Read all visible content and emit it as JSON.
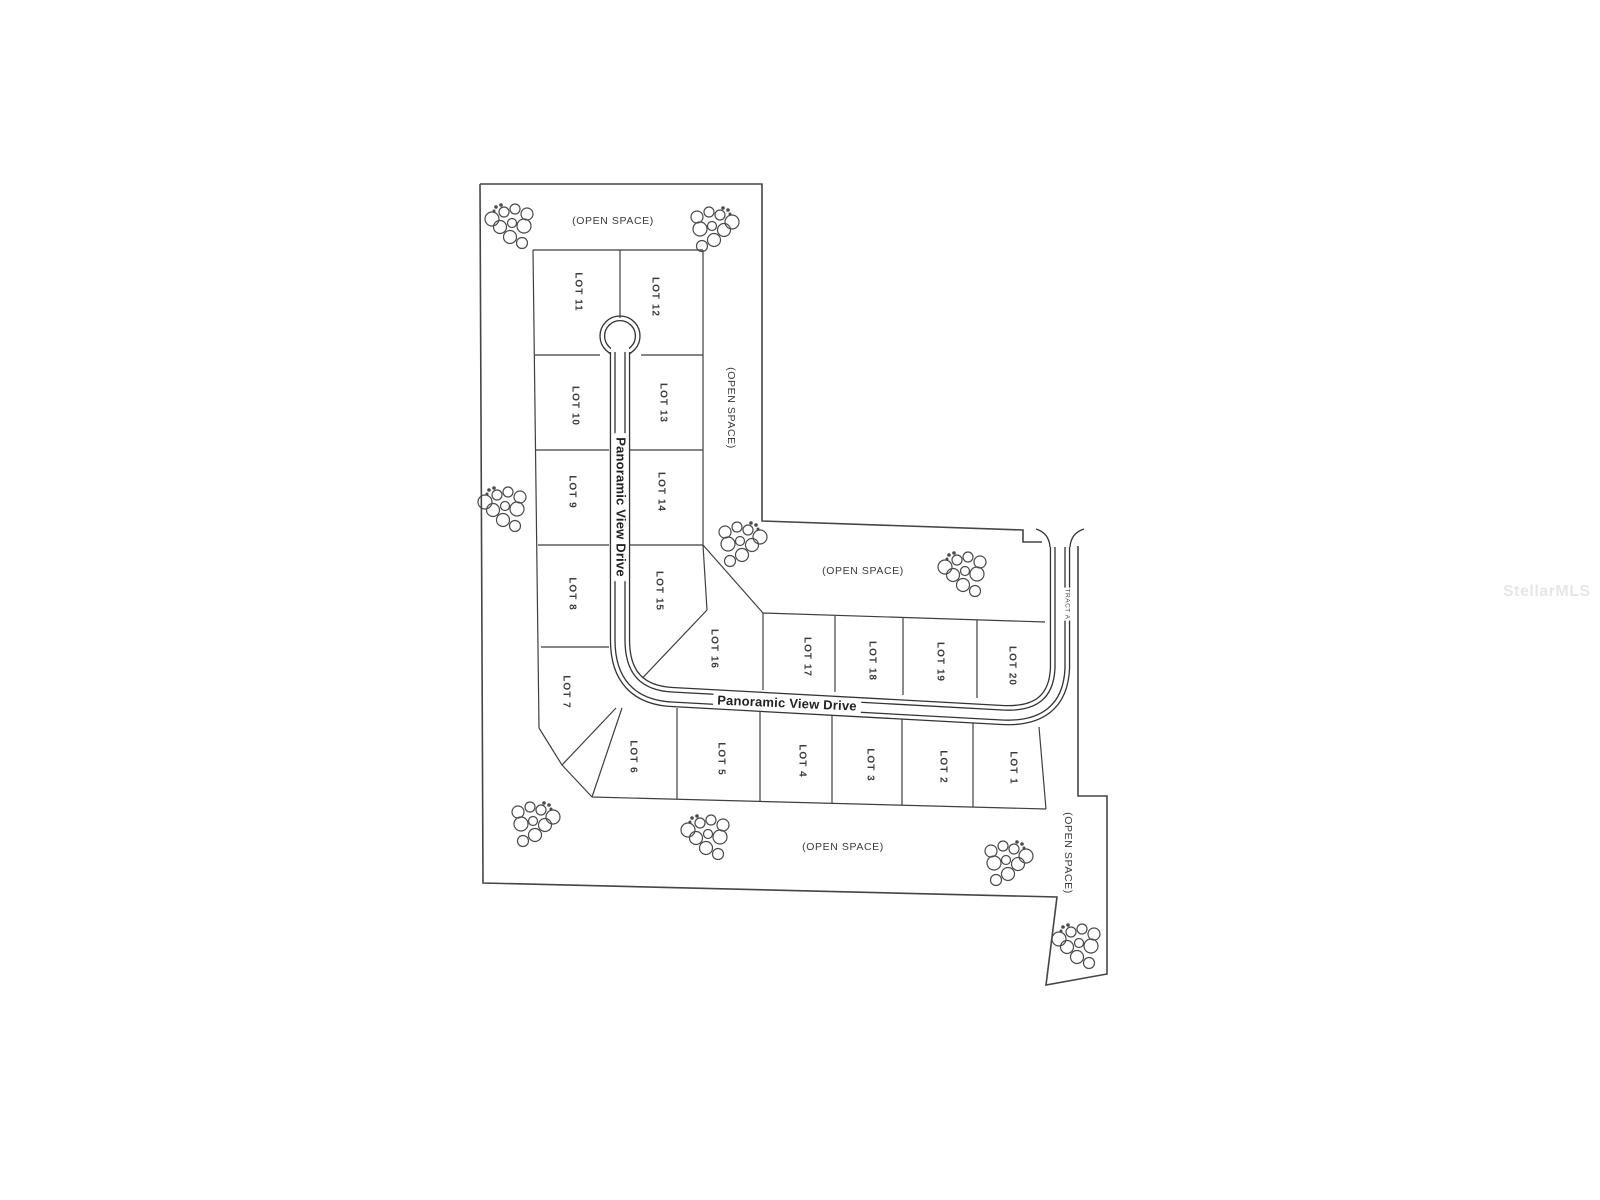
{
  "canvas": {
    "background": "#ffffff",
    "ink": "#3f3f3f",
    "road_ink": "#333333",
    "boundary_ink": "#454545",
    "tree_ink": "#4a4a4a"
  },
  "watermark": {
    "text": "StellarMLS",
    "color": "#e7e7e7",
    "x": 1503,
    "y": 592
  },
  "plat": {
    "road_name": "Panoramic View Drive",
    "tract_label": "TRACT A",
    "open_space_label": "(OPEN SPACE)",
    "labels": [
      {
        "id": "lot-11",
        "text": "LOT 11",
        "x": 578,
        "y": 292,
        "rot": 90,
        "kind": "lot"
      },
      {
        "id": "lot-12",
        "text": "LOT 12",
        "x": 655,
        "y": 297,
        "rot": 90,
        "kind": "lot"
      },
      {
        "id": "lot-10",
        "text": "LOT 10",
        "x": 575,
        "y": 406,
        "rot": 90,
        "kind": "lot"
      },
      {
        "id": "lot-13",
        "text": "LOT 13",
        "x": 663,
        "y": 403,
        "rot": 90,
        "kind": "lot"
      },
      {
        "id": "lot-9",
        "text": "LOT 9",
        "x": 572,
        "y": 492,
        "rot": 90,
        "kind": "lot"
      },
      {
        "id": "lot-14",
        "text": "LOT 14",
        "x": 661,
        "y": 492,
        "rot": 90,
        "kind": "lot"
      },
      {
        "id": "lot-8",
        "text": "LOT 8",
        "x": 572,
        "y": 594,
        "rot": 90,
        "kind": "lot"
      },
      {
        "id": "lot-15",
        "text": "LOT 15",
        "x": 659,
        "y": 591,
        "rot": 90,
        "kind": "lot"
      },
      {
        "id": "lot-7",
        "text": "LOT 7",
        "x": 566,
        "y": 692,
        "rot": 90,
        "kind": "lot"
      },
      {
        "id": "lot-16",
        "text": "LOT 16",
        "x": 714,
        "y": 649,
        "rot": 90,
        "kind": "lot"
      },
      {
        "id": "lot-17",
        "text": "LOT 17",
        "x": 807,
        "y": 657,
        "rot": 90,
        "kind": "lot"
      },
      {
        "id": "lot-18",
        "text": "LOT 18",
        "x": 872,
        "y": 661,
        "rot": 90,
        "kind": "lot"
      },
      {
        "id": "lot-19",
        "text": "LOT 19",
        "x": 940,
        "y": 662,
        "rot": 90,
        "kind": "lot"
      },
      {
        "id": "lot-20",
        "text": "LOT 20",
        "x": 1012,
        "y": 666,
        "rot": 90,
        "kind": "lot"
      },
      {
        "id": "lot-6",
        "text": "LOT 6",
        "x": 633,
        "y": 757,
        "rot": 90,
        "kind": "lot"
      },
      {
        "id": "lot-5",
        "text": "LOT 5",
        "x": 721,
        "y": 759,
        "rot": 90,
        "kind": "lot"
      },
      {
        "id": "lot-4",
        "text": "LOT 4",
        "x": 802,
        "y": 761,
        "rot": 90,
        "kind": "lot"
      },
      {
        "id": "lot-3",
        "text": "LOT 3",
        "x": 870,
        "y": 765,
        "rot": 90,
        "kind": "lot"
      },
      {
        "id": "lot-2",
        "text": "LOT 2",
        "x": 943,
        "y": 767,
        "rot": 90,
        "kind": "lot"
      },
      {
        "id": "lot-1",
        "text": "LOT 1",
        "x": 1013,
        "y": 768,
        "rot": 90,
        "kind": "lot"
      },
      {
        "id": "open-space-top",
        "text": "(OPEN SPACE)",
        "x": 613,
        "y": 221,
        "rot": 0,
        "kind": "open"
      },
      {
        "id": "open-space-right",
        "text": "(OPEN SPACE)",
        "x": 731,
        "y": 408,
        "rot": 90,
        "kind": "open"
      },
      {
        "id": "open-space-middle",
        "text": "(OPEN SPACE)",
        "x": 863,
        "y": 571,
        "rot": 0,
        "kind": "open"
      },
      {
        "id": "open-space-bottom",
        "text": "(OPEN SPACE)",
        "x": 843,
        "y": 847,
        "rot": 0,
        "kind": "open"
      },
      {
        "id": "open-space-bottom-right",
        "text": "(OPEN SPACE)",
        "x": 1068,
        "y": 853,
        "rot": 90,
        "kind": "open"
      },
      {
        "id": "tract-a",
        "text": "TRACT A",
        "x": 1067,
        "y": 604,
        "rot": 90,
        "kind": "tract"
      },
      {
        "id": "road-name-vertical",
        "text": "Panoramic View Drive",
        "x": 621,
        "y": 507,
        "rot": 90,
        "kind": "road"
      },
      {
        "id": "road-name-horizontal",
        "text": "Panoramic View Drive",
        "x": 787,
        "y": 703,
        "rot": 2.5,
        "kind": "road"
      }
    ],
    "tree_clusters": [
      {
        "x": 512,
        "y": 227,
        "flip": 1
      },
      {
        "x": 712,
        "y": 230,
        "flip": -1
      },
      {
        "x": 505,
        "y": 510,
        "flip": 1
      },
      {
        "x": 740,
        "y": 545,
        "flip": -1
      },
      {
        "x": 965,
        "y": 575,
        "flip": 1
      },
      {
        "x": 533,
        "y": 825,
        "flip": -1
      },
      {
        "x": 708,
        "y": 838,
        "flip": 1
      },
      {
        "x": 1006,
        "y": 864,
        "flip": -1
      },
      {
        "x": 1079,
        "y": 947,
        "flip": 1
      }
    ]
  }
}
